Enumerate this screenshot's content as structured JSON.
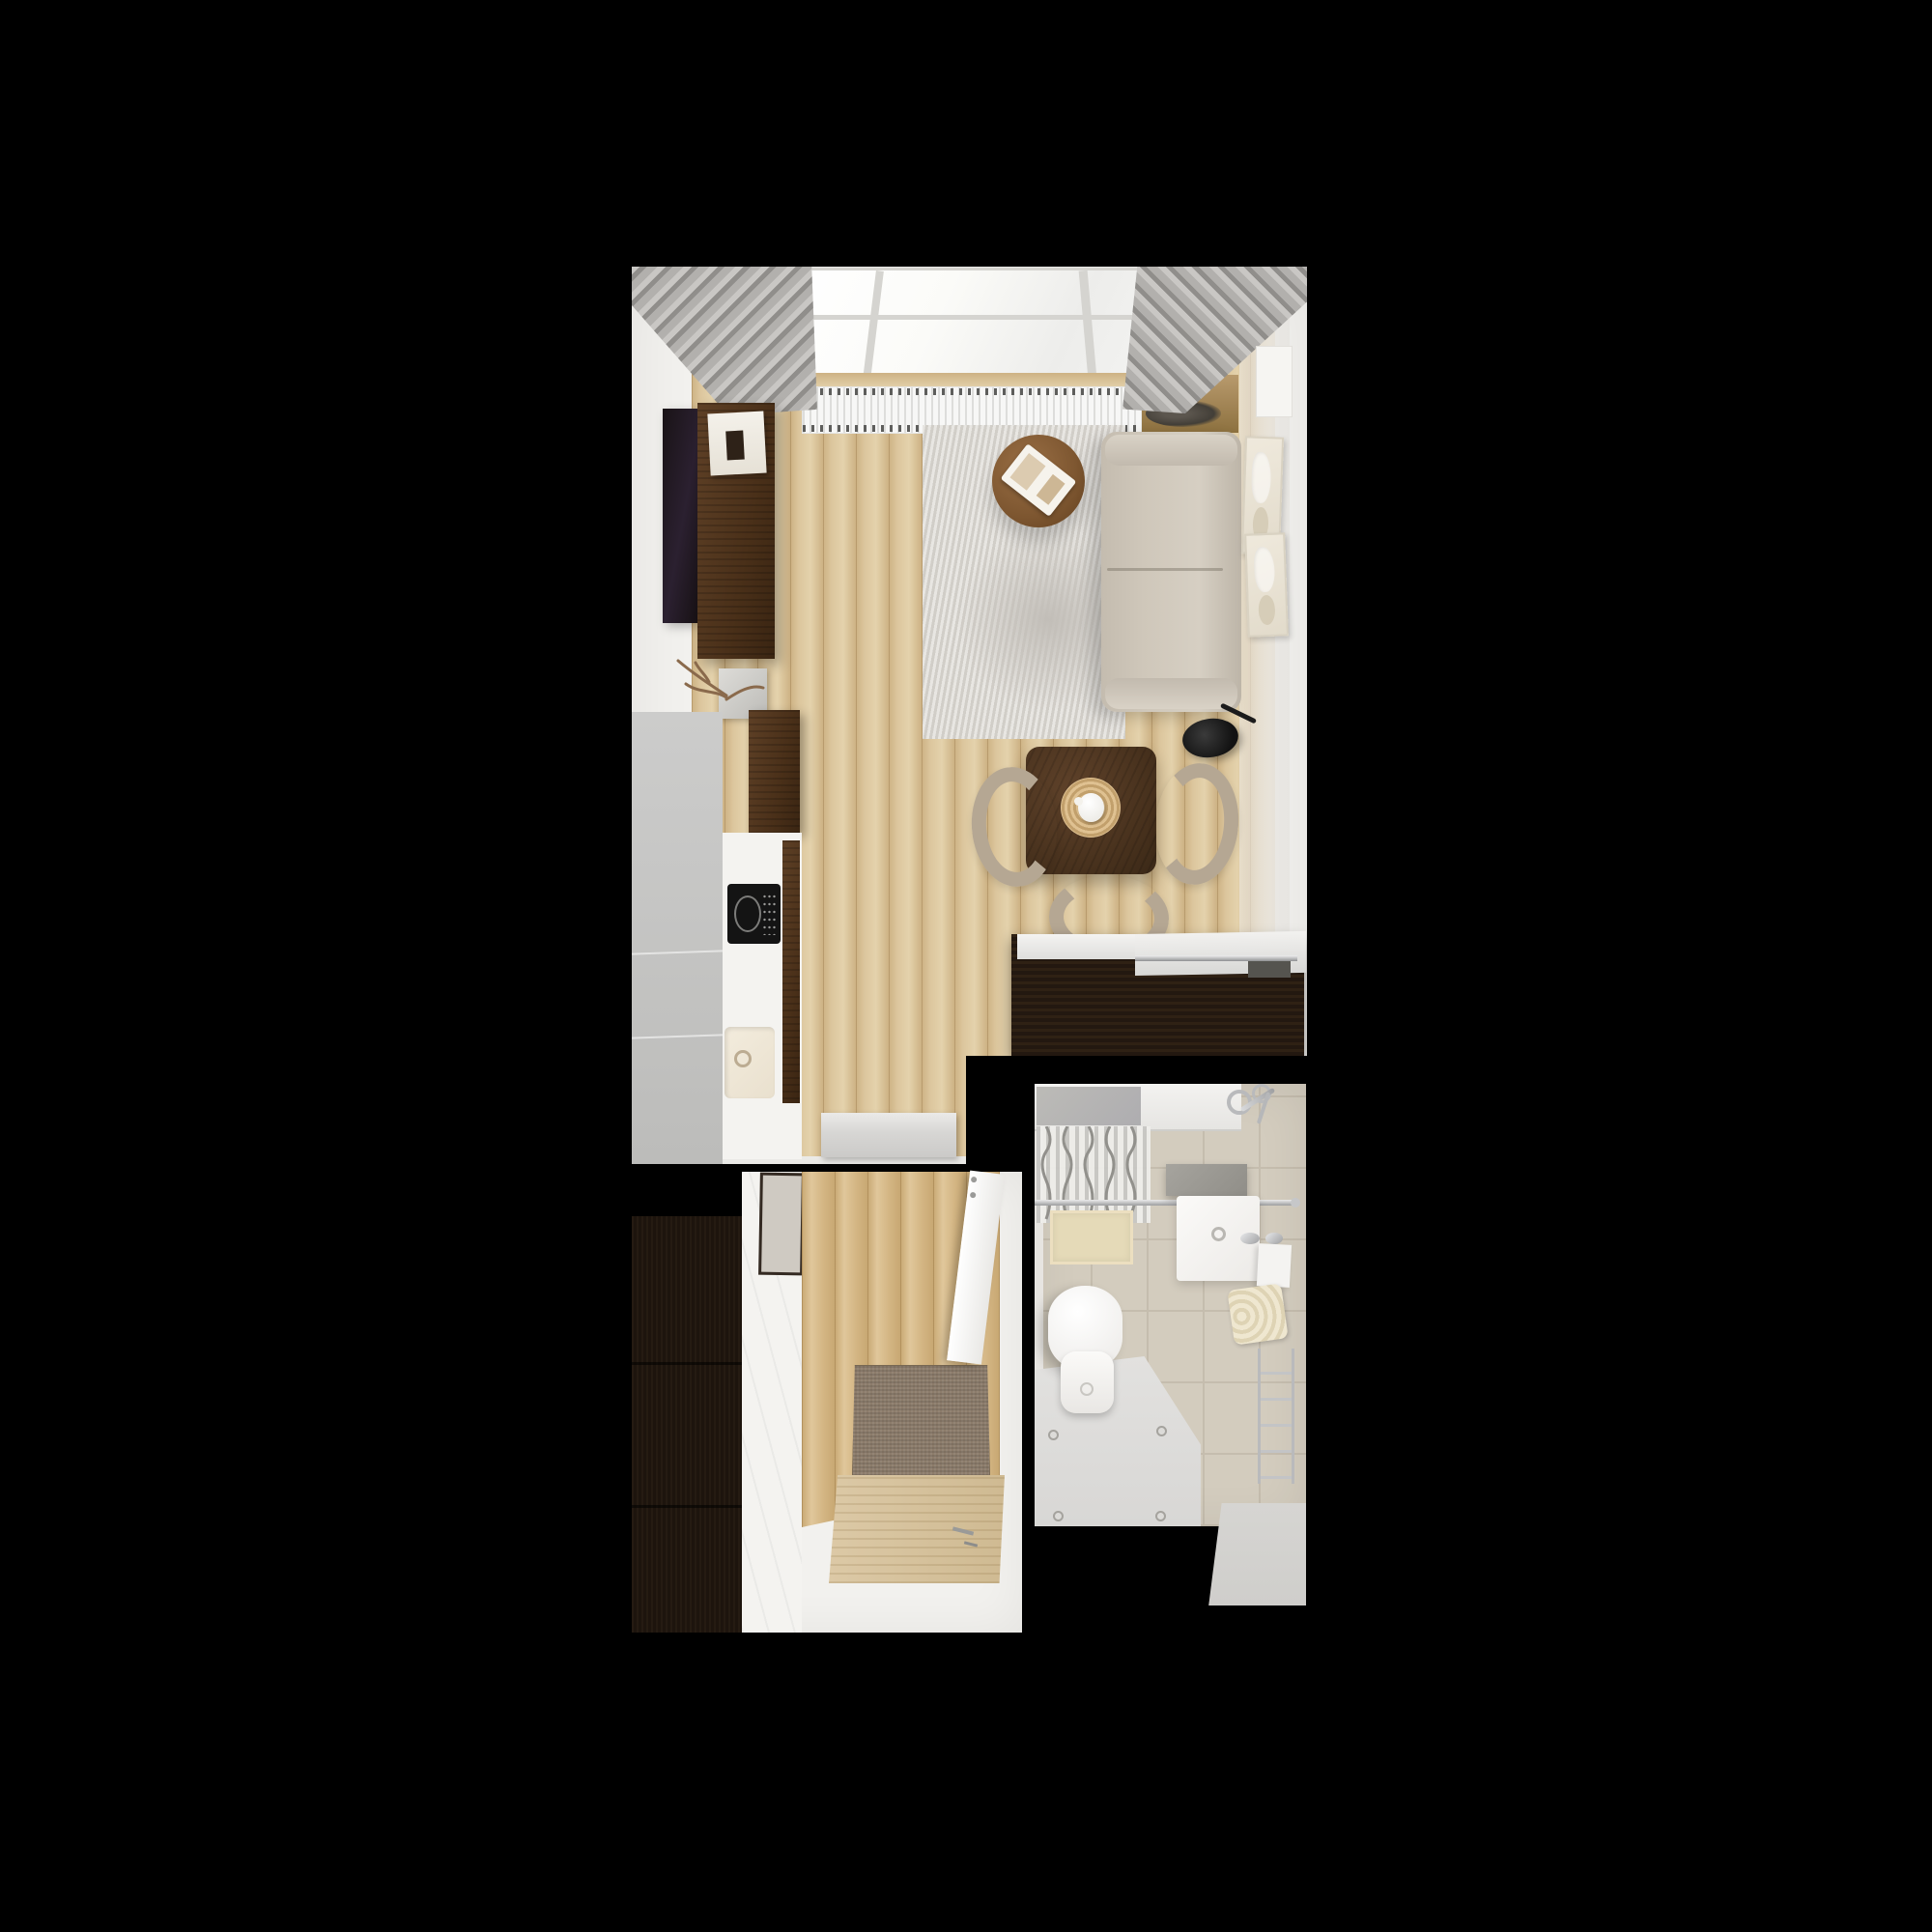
{
  "scene": {
    "type": "apartment-interior-top-view-3d-render",
    "view": "top-down floor plan on black background"
  },
  "palette": {
    "bg": "#000000",
    "wall": "#f2f1ee",
    "wallShade": "#e7e5e1",
    "woodA": "#e4d2ac",
    "woodB": "#cdb284",
    "woodC": "#dcc69d",
    "walnut": "#4a3019",
    "espresso": "#261a10",
    "wardrobe": "#1d140d",
    "sofa": "#cfc7ba",
    "rug": "#dcd9d3",
    "rugShadow": "#c2beb8",
    "chair": "#b5a793",
    "curtain": "#b2b0ad",
    "curtainDark": "#908e8b",
    "windowFrame": "#d5d4d0",
    "radiator": "#f7f7f6",
    "counter": "#f4f3f0",
    "hob": "#141414",
    "tile": "#d3ccbe",
    "tileSeam": "#c5bdae",
    "chrome": "#b9babc",
    "matBeige": "#e5dab8",
    "doormat": "#8c7c6b",
    "towel": "#efe7d0",
    "thresholdGray": "#d7d6d4"
  },
  "labels": {
    "stage": "3D top-down render of a studio apartment floor plan",
    "living": "Living room with kitchenette and dining area",
    "hall": "Entrance hallway",
    "bath": "Bathroom",
    "window": "Window wall with skylight glazing",
    "curtainLeft": "Gray curtain, left side",
    "curtainRight": "Gray curtain, right side",
    "radiator": "Radiator under window",
    "sill": "Wooden windowsill",
    "plant": "Plant on windowsill",
    "tv": "Wall-mounted TV",
    "tvConsole": "Walnut TV console with book and vase",
    "book": "Book on console",
    "decorBranch": "Decorative branch sculpture",
    "kitchenUnit": "Tall gray kitchen unit",
    "kitchenCabinet": "Walnut kitchen cabinet",
    "counter": "White kitchen countertop",
    "hob": "Black induction hob",
    "sink": "Kitchen sink",
    "threshold": "Stone threshold step",
    "rug": "Light gray area rug",
    "coffeeTable": "Round walnut coffee table with white tray",
    "sofa": "Beige two-seat sofa",
    "wallArt": "Cream abstract wall art",
    "floorLamp": "Black arc floor lamp",
    "diningTable": "Square walnut dining table",
    "placemat": "Rattan placemat with white teapot",
    "chair": "Beige dining chair",
    "sideboard": "Dark sideboard with white sliding top",
    "wardrobe": "Dark hallway wardrobe",
    "mirror": "Framed mirror",
    "hallFloor": "Hallway wood floor",
    "doormat": "Brown entry doormat",
    "entryDoor": "Wooden entrance door with handle",
    "openDoor": "Open white bathroom door",
    "bathtub": "Bathtub with gray interior",
    "showerMixer": "Chrome shower mixer",
    "showerCurtain": "Gray shower curtain",
    "showerRail": "Chrome shower rail",
    "bathMat": "Beige bath mat",
    "shelf": "Gray bathroom shelf",
    "washbasin": "White washbasin with chrome faucet",
    "sidePanel": "White cabinet panel",
    "towels": "Folded cream towels",
    "toilet": "White toilet",
    "towelLadder": "Chrome towel ladder rail",
    "bathFloor": "Bright bathroom floor panels"
  }
}
